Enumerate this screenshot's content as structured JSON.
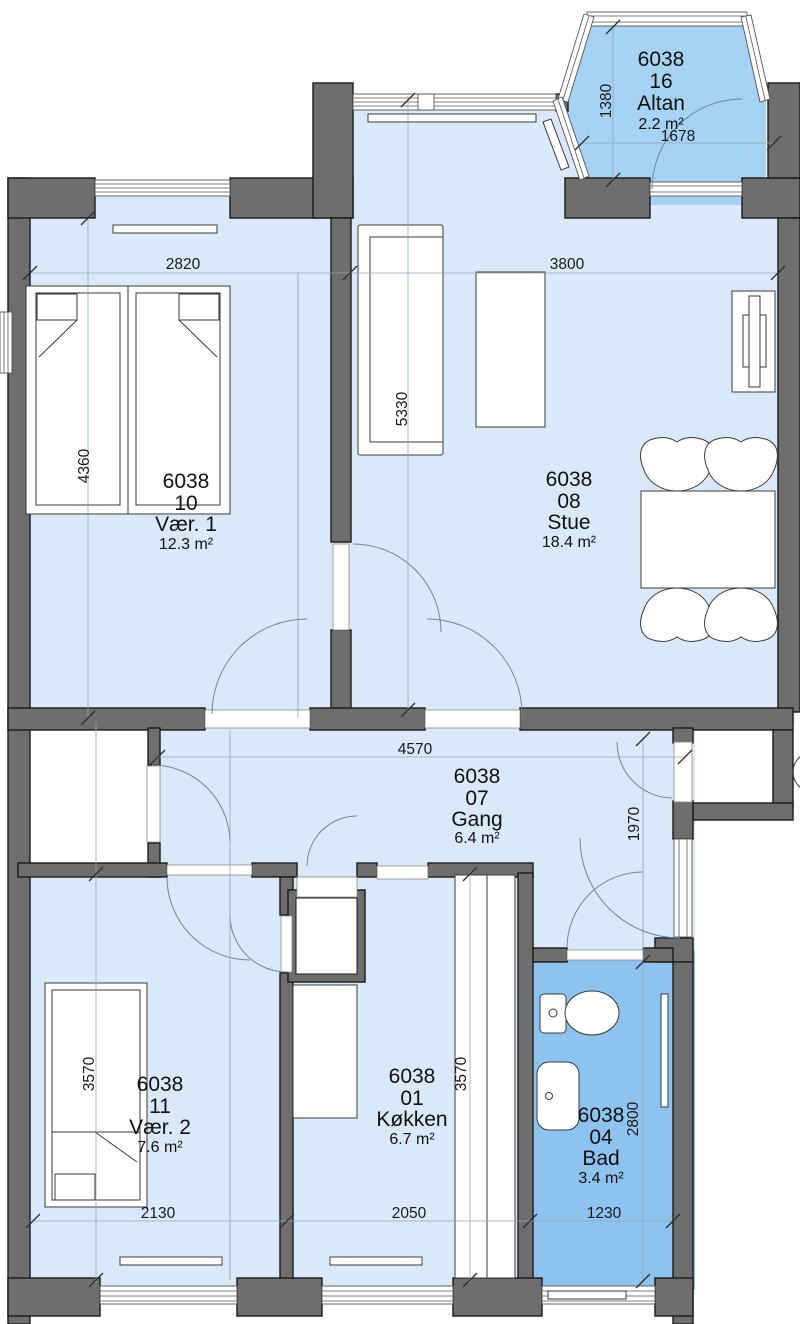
{
  "plan": {
    "unit": "6038",
    "rooms": [
      {
        "unit": "6038",
        "number": "16",
        "name": "Altan",
        "area": "2.2 m²"
      },
      {
        "unit": "6038",
        "number": "10",
        "name": "Vær. 1",
        "area": "12.3 m²"
      },
      {
        "unit": "6038",
        "number": "08",
        "name": "Stue",
        "area": "18.4 m²"
      },
      {
        "unit": "6038",
        "number": "07",
        "name": "Gang",
        "area": "6.4 m²"
      },
      {
        "unit": "6038",
        "number": "11",
        "name": "Vær. 2",
        "area": "7.6 m²"
      },
      {
        "unit": "6038",
        "number": "01",
        "name": "Køkken",
        "area": "6.7 m²"
      },
      {
        "unit": "6038",
        "number": "04",
        "name": "Bad",
        "area": "3.4 m²"
      }
    ],
    "dims": {
      "altan_depth": "1380",
      "altan_width": "1678",
      "vaer1_width": "2820",
      "vaer1_depth": "4360",
      "stue_width": "3800",
      "stue_depth": "5330",
      "gang_width": "4570",
      "entry_depth": "1970",
      "vaer2_width": "2130",
      "vaer2_depth": "3570",
      "koekken_width": "2050",
      "koekken_depth": "3570",
      "bad_width": "1230",
      "bad_depth": "2800"
    },
    "colors": {
      "room_fill": "#D9E9F9",
      "balcony_fill": "#A6D2F4",
      "bath_fill": "#8FC3EF",
      "wall_fill": "#6E6E6E"
    }
  }
}
